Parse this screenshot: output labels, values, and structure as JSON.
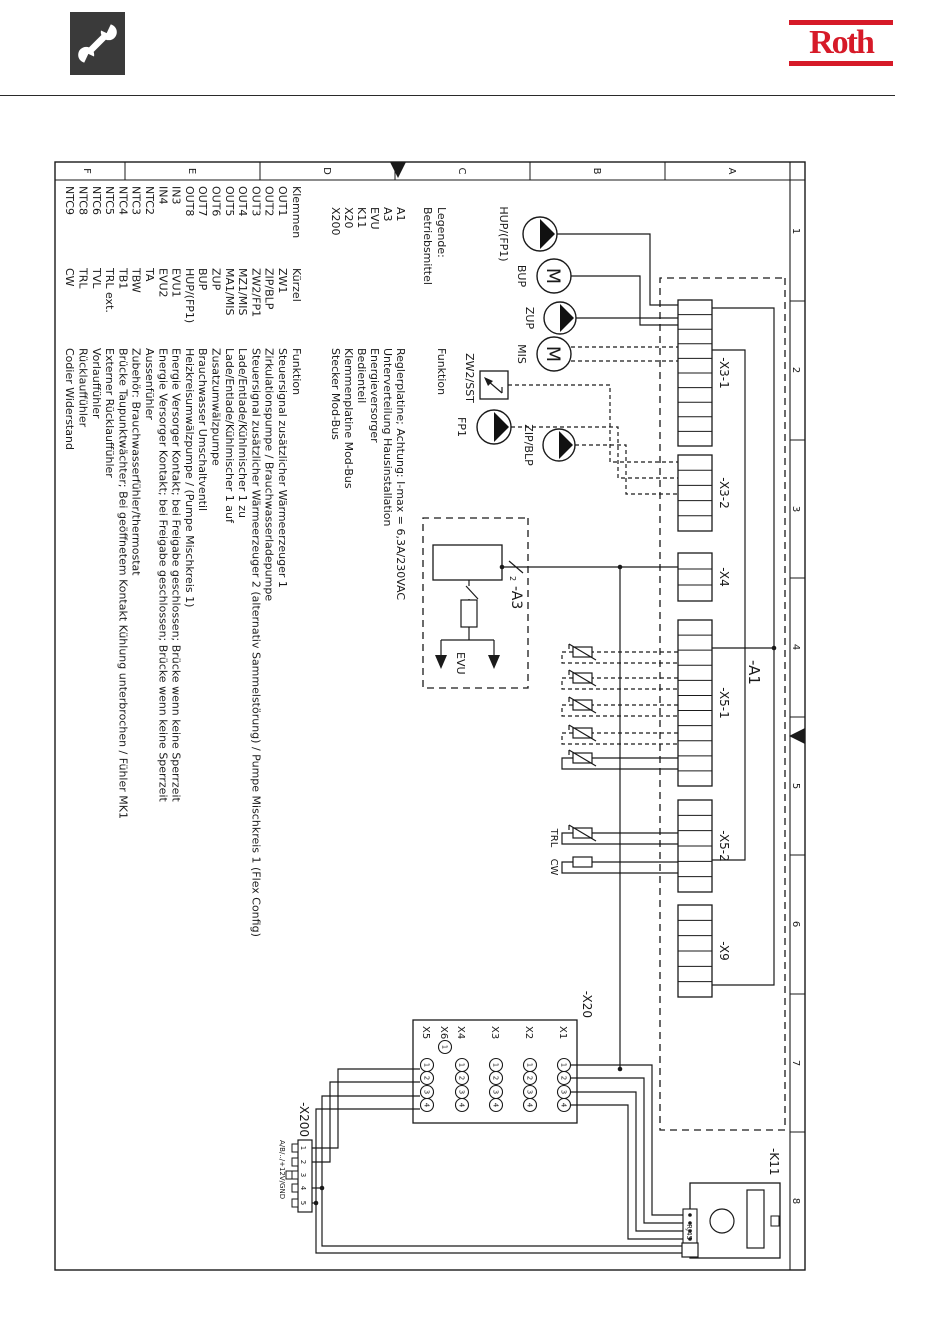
{
  "header": {
    "brand": "Roth"
  },
  "frame": {
    "letters": [
      "A",
      "B",
      "C",
      "D",
      "E",
      "F"
    ],
    "numbers": [
      "1",
      "2",
      "3",
      "4",
      "5",
      "6",
      "7",
      "8"
    ]
  },
  "legend": {
    "title1": "Legende:",
    "title2": "Betriebsmittel",
    "funktion_header": "Funktion",
    "devices": [
      {
        "label": "A1",
        "funktion": "Reglerplatine; Achtung: I-max = 6,3A/230VAC"
      },
      {
        "label": "A3",
        "funktion": "Unterverteilung Hausinstallation"
      },
      {
        "label": "EVU",
        "funktion": "Energieversorger"
      },
      {
        "label": "K11",
        "funktion": "Bedienteil"
      },
      {
        "label": "X20",
        "funktion": "Klemmenplatine Mod-Bus"
      },
      {
        "label": "X200",
        "funktion": "Stecker Mod-Bus"
      }
    ],
    "columns": {
      "klemmen": "Klemmen",
      "kurzel": "Kürzel",
      "funktion": "Funktion"
    },
    "terminals": [
      {
        "klemme": "OUT1",
        "kurzel": "ZW1",
        "funktion": "Steuersignal zusätzlicher Wärmeerzeuger 1"
      },
      {
        "klemme": "OUT2",
        "kurzel": "ZIP/BLP",
        "funktion": "Zirkulationspumpe / Brauchwasserladepumpe"
      },
      {
        "klemme": "OUT3",
        "kurzel": "ZW2/FP1",
        "funktion": "Steuersignal zusätzlicher Wärmeerzeuger 2 (alternativ Sammelstörung) / Pumpe Mischkreis 1 (Flex Config)"
      },
      {
        "klemme": "OUT4",
        "kurzel": "MZ1/MIS",
        "funktion": "Lade/Entlade/Kühlmischer 1 zu"
      },
      {
        "klemme": "OUT5",
        "kurzel": "MA1/MIS",
        "funktion": "Lade/Entlade/Kühlmischer 1 auf"
      },
      {
        "klemme": "OUT6",
        "kurzel": "ZUP",
        "funktion": "Zusatzumwälzpumpe"
      },
      {
        "klemme": "OUT7",
        "kurzel": "BUP",
        "funktion": "Brauchwasser Umschaltventil"
      },
      {
        "klemme": "OUT8",
        "kurzel": "HUP/(FP1)",
        "funktion": "Heizkreisumwälzpumpe / (Pumpe Mischkreis 1)"
      },
      {
        "klemme": "IN3",
        "kurzel": "EVU1",
        "funktion": "Energie Versorger Kontakt; bei Freigabe geschlossen; Brücke wenn keine Sperrzeit"
      },
      {
        "klemme": "IN4",
        "kurzel": "EVU2",
        "funktion": "Energie Versorger Kontakt; bei Freigabe geschlossen; Brücke wenn keine Sperrzeit"
      },
      {
        "klemme": "NTC2",
        "kurzel": "TA",
        "funktion": "Aussenfühler"
      },
      {
        "klemme": "NTC3",
        "kurzel": "TBW",
        "funktion": "Zubehör: Brauchwasserfühler/thermostat"
      },
      {
        "klemme": "NTC4",
        "kurzel": "TB1",
        "funktion": "Brücke Taupunktwächter; Bei geöffnetem Kontakt Kühlung unterbrochen / Fühler MK1"
      },
      {
        "klemme": "NTC5",
        "kurzel": "TRL ext.",
        "funktion": "Externer Rücklauffühler"
      },
      {
        "klemme": "NTC6",
        "kurzel": "TVL",
        "funktion": "Vorlauffühler"
      },
      {
        "klemme": "NTC8",
        "kurzel": "TRL",
        "funktion": "Rücklauffühler"
      },
      {
        "klemme": "NTC9",
        "kurzel": "CW",
        "funktion": "Codier Widerstand"
      }
    ]
  },
  "schematic": {
    "a1_label": "-A1",
    "connectors": [
      {
        "label": "-X3-1",
        "pins": 10
      },
      {
        "label": "-X3-2",
        "pins": 5
      },
      {
        "label": "-X4",
        "pins": 3
      },
      {
        "label": "-X5-1",
        "pins": 11
      },
      {
        "label": "-X5-2",
        "pins": 6
      },
      {
        "label": "-X9",
        "pins": 6
      }
    ],
    "pumps": [
      {
        "label": "HUP/(FP1)",
        "type": "pump"
      },
      {
        "label": "BUP",
        "type": "motor"
      },
      {
        "label": "ZUP",
        "type": "pump"
      },
      {
        "label": "MIS",
        "type": "motor"
      },
      {
        "label": "ZIP/BLP",
        "type": "pump"
      },
      {
        "label": "FP1",
        "type": "pump"
      }
    ],
    "zw2_label": "ZW2/SST",
    "a3": {
      "label": "-A3",
      "evu_label": "EVU",
      "wire_mark": "2"
    },
    "sensors": [
      {
        "label": ""
      },
      {
        "label": ""
      },
      {
        "label": ""
      },
      {
        "label": ""
      },
      {
        "label": ""
      },
      {
        "label": "TRL"
      },
      {
        "label": "CW"
      }
    ],
    "x20": {
      "label": "-X20",
      "rows": [
        {
          "label": "X1",
          "pins": [
            "1",
            "2",
            "3",
            "4"
          ]
        },
        {
          "label": "X2",
          "pins": [
            "1",
            "2",
            "3",
            "4"
          ]
        },
        {
          "label": "X3",
          "pins": [
            "1",
            "2",
            "3",
            "4"
          ]
        },
        {
          "label": "X4",
          "pins": [
            "1",
            "2",
            "3",
            "4"
          ]
        },
        {
          "label": "X5",
          "pins": [
            "1",
            "2",
            "3",
            "4"
          ]
        }
      ],
      "x6": {
        "label": "X6",
        "pin": "1"
      }
    },
    "x200": {
      "label": "-X200",
      "pins": [
        "1",
        "2",
        "3",
        "4",
        "5"
      ],
      "note": "A/B/../+12V/GND"
    },
    "k11": {
      "label": "-K11",
      "rj45": "RJ45"
    }
  }
}
